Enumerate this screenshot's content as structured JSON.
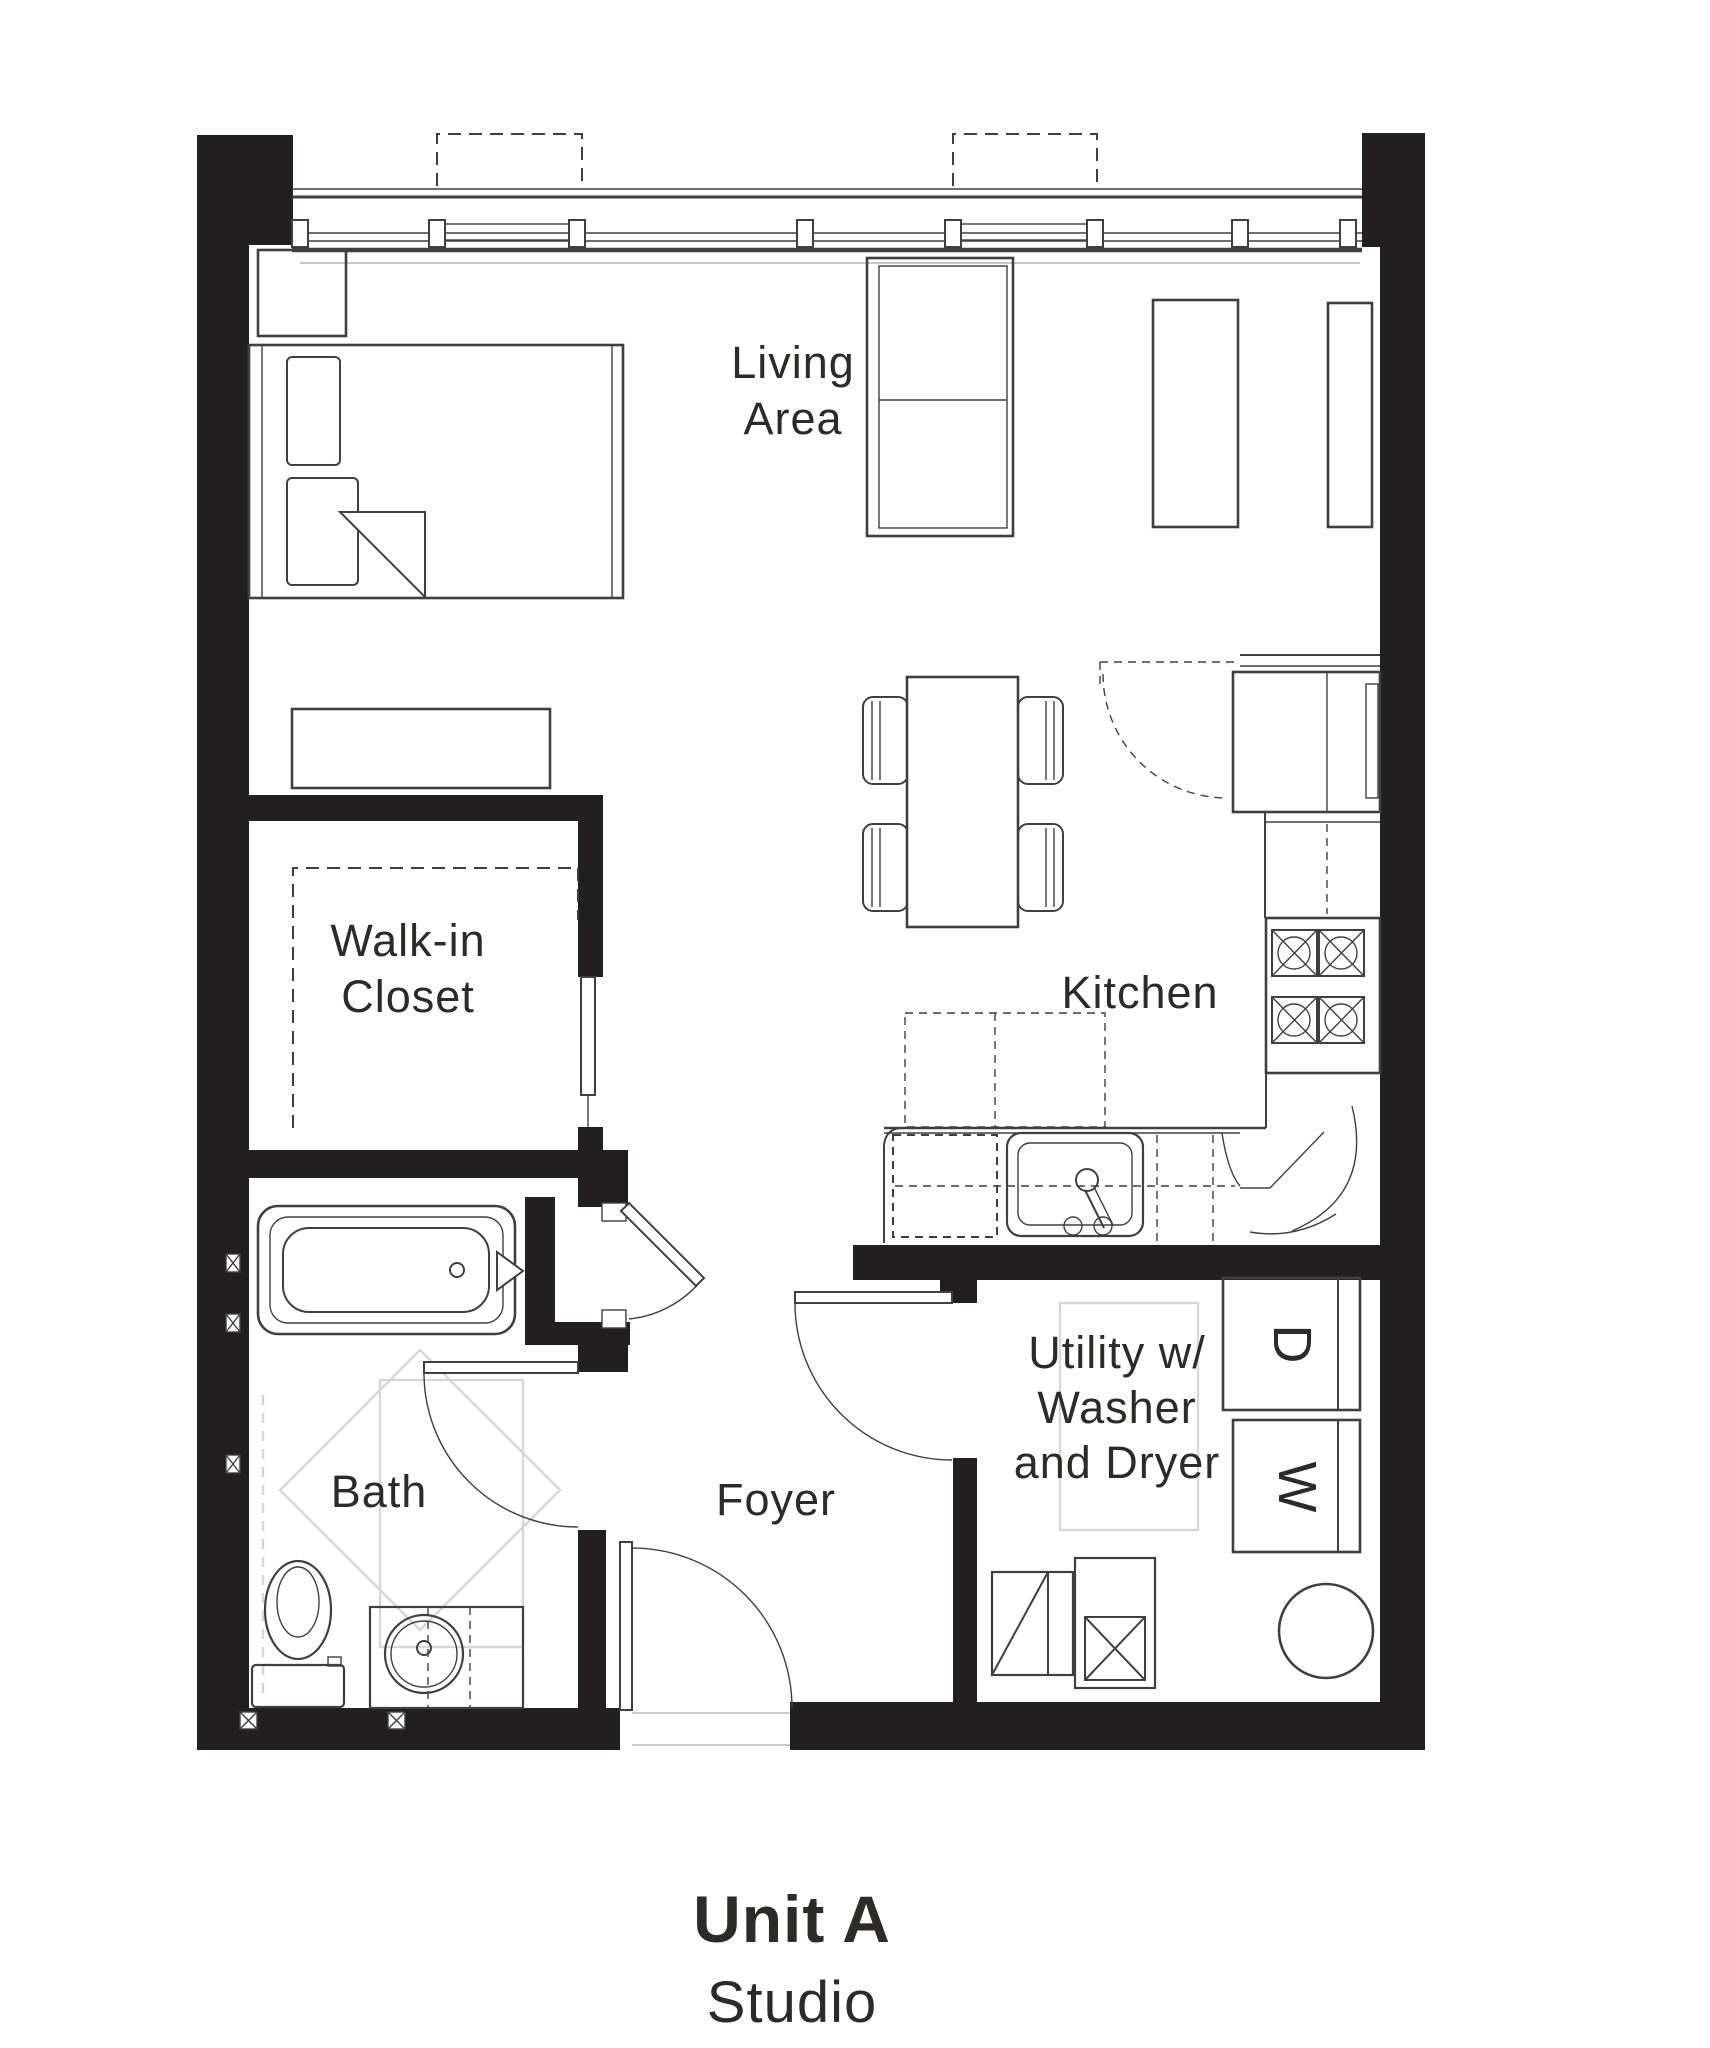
{
  "title": {
    "unit_name": "Unit A",
    "unit_type": "Studio"
  },
  "rooms": {
    "living": {
      "line1": "Living",
      "line2": "Area"
    },
    "walk_in_closet": {
      "line1": "Walk-in",
      "line2": "Closet"
    },
    "kitchen": {
      "label": "Kitchen"
    },
    "bath": {
      "label": "Bath"
    },
    "foyer": {
      "label": "Foyer"
    },
    "utility": {
      "line1": "Utility w/",
      "line2": "Washer",
      "line3": "and Dryer"
    }
  },
  "appliances": {
    "dryer_label": "D",
    "washer_label": "W"
  },
  "colors": {
    "wall": "#231f20",
    "line": "#3f3f41",
    "ghost": "#d7d7d7",
    "text": "#2c2b2a"
  }
}
